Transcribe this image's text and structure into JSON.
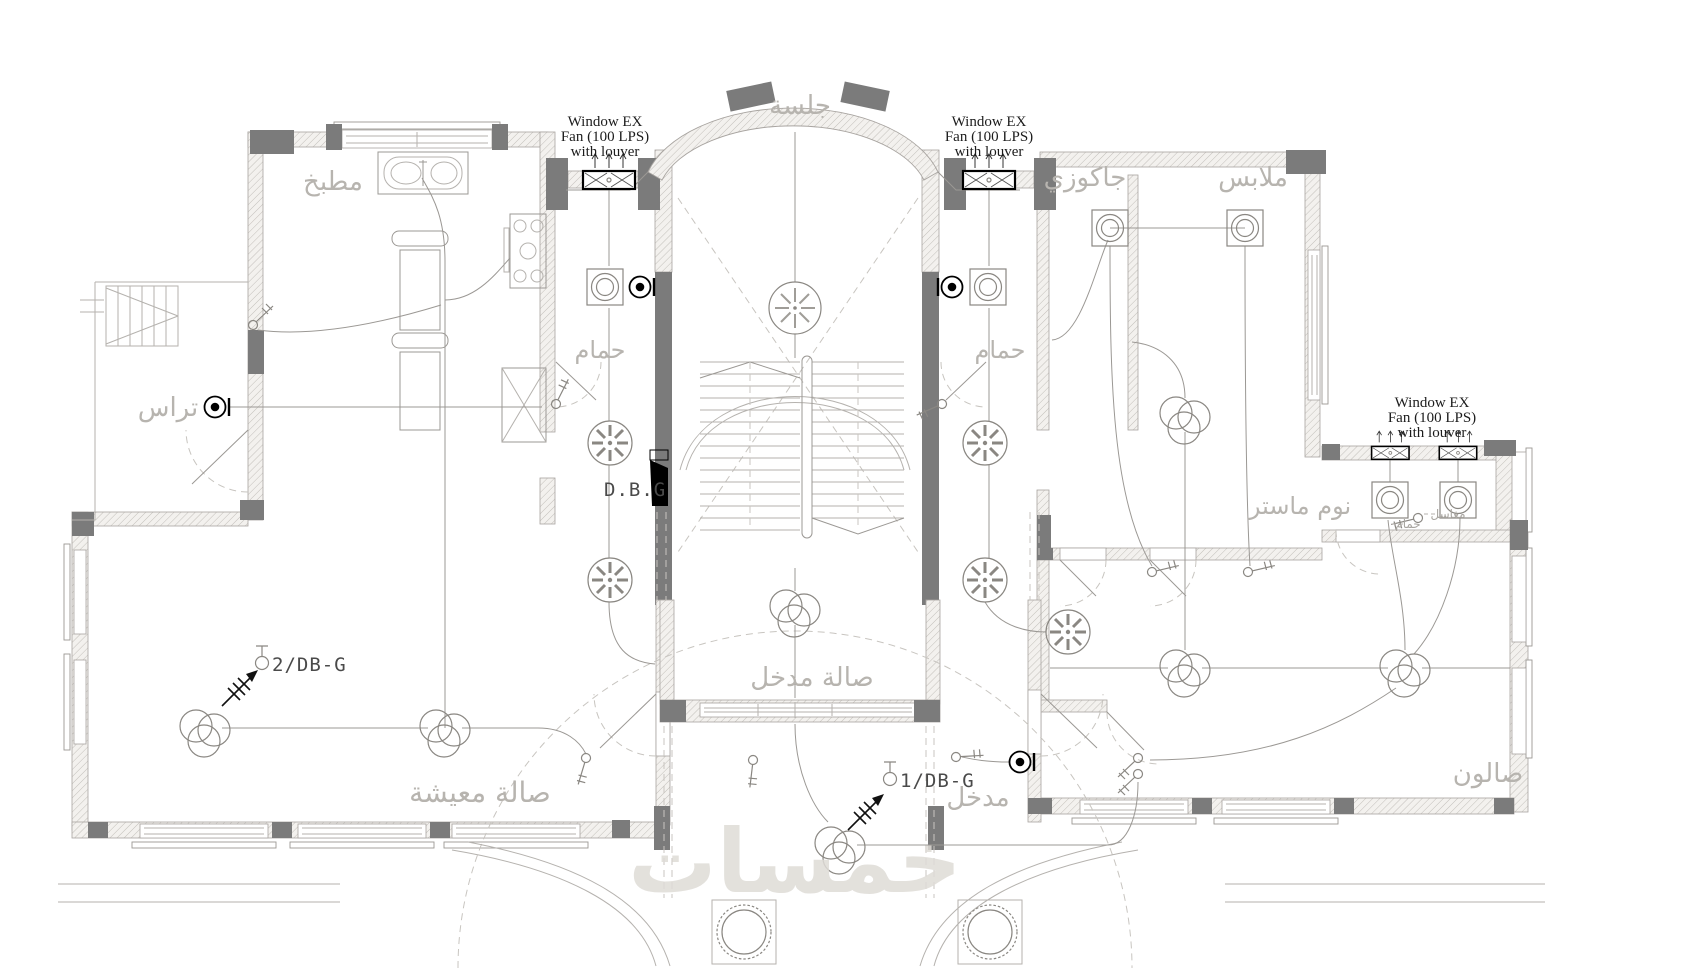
{
  "drawing": {
    "type": "electrical-lighting-floor-plan",
    "annotations": {
      "window_fan": {
        "l1": "Window EX",
        "l2": "Fan (100 LPS)",
        "l3": "with louver"
      },
      "db_board": "D.B.G",
      "circuit_2": "2/DB-G",
      "circuit_1": "1/DB-G"
    },
    "rooms": {
      "sitting": "جلسة",
      "kitchen": "مطبخ",
      "jacuzzi": "جاكوزي",
      "closet": "ملابس",
      "bath_left": "حمام",
      "bath_right": "حمام",
      "terrace": "تراس",
      "master_bedroom": "نوم ماستر",
      "master_bath_small": "حمام",
      "sinks_small": "مغاسل",
      "living": "صالة معيشة",
      "entry_hall": "صالة مدخل",
      "entry": "مدخل",
      "salon": "صالون"
    },
    "watermark": "خمسات",
    "colors": {
      "wall_dark": "#7b7b7b",
      "thin_line": "#9b9894",
      "room_label": "#b7b4af",
      "annotation": "#1c1c1c",
      "watermark": "#dfdcd7"
    },
    "symbols": [
      "ceiling-light-square",
      "ceiling-fan",
      "exhaust-fan",
      "wall-light",
      "window-exhaust-fan-box",
      "light-cluster",
      "switch",
      "homerun-arrow",
      "db-board-wedge"
    ]
  }
}
